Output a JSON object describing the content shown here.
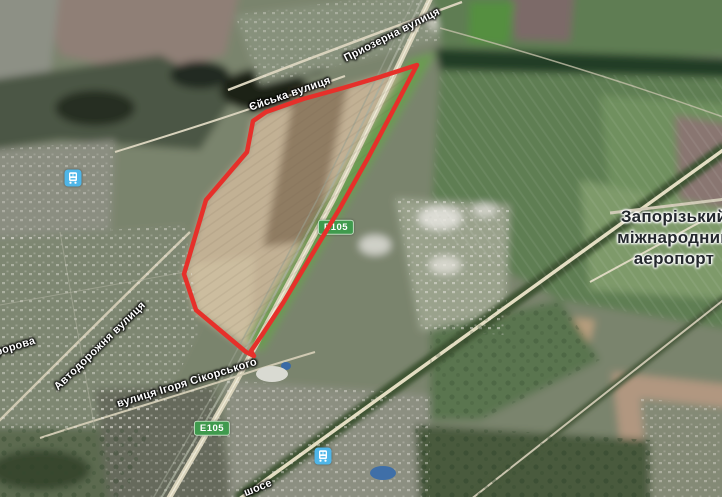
{
  "map": {
    "view": "satellite"
  },
  "street_labels": [
    {
      "text": "Приозерна вулиця"
    },
    {
      "text": "Єйська вулиця"
    },
    {
      "text": "Автодорожня вулиця"
    },
    {
      "text": "вулиця Ігоря Сікорського"
    },
    {
      "text": "форова"
    },
    {
      "text": "шосе"
    }
  ],
  "place_label": {
    "lines": [
      "Запорізький",
      "міжнародний",
      "аеропорт"
    ]
  },
  "road_badges": [
    {
      "label": "E105"
    },
    {
      "label": "E105"
    }
  ],
  "transit_stations": [
    {
      "icon": "train-station-icon"
    },
    {
      "icon": "train-station-icon"
    }
  ],
  "overlay": {
    "color": "#e6302a",
    "points": [
      [
        417,
        65
      ],
      [
        396,
        105
      ],
      [
        368,
        158
      ],
      [
        340,
        208
      ],
      [
        310,
        258
      ],
      [
        283,
        303
      ],
      [
        262,
        335
      ],
      [
        251,
        351
      ],
      [
        254,
        356
      ],
      [
        246,
        352
      ],
      [
        196,
        310
      ],
      [
        184,
        274
      ],
      [
        206,
        200
      ],
      [
        247,
        152
      ],
      [
        253,
        121
      ],
      [
        266,
        112
      ],
      [
        303,
        99
      ],
      [
        343,
        88
      ],
      [
        380,
        77
      ]
    ]
  },
  "colors": {
    "badge_green": "#3f9a4d",
    "transit_blue": "#4fb6e8",
    "overlay_red": "#e6302a"
  }
}
